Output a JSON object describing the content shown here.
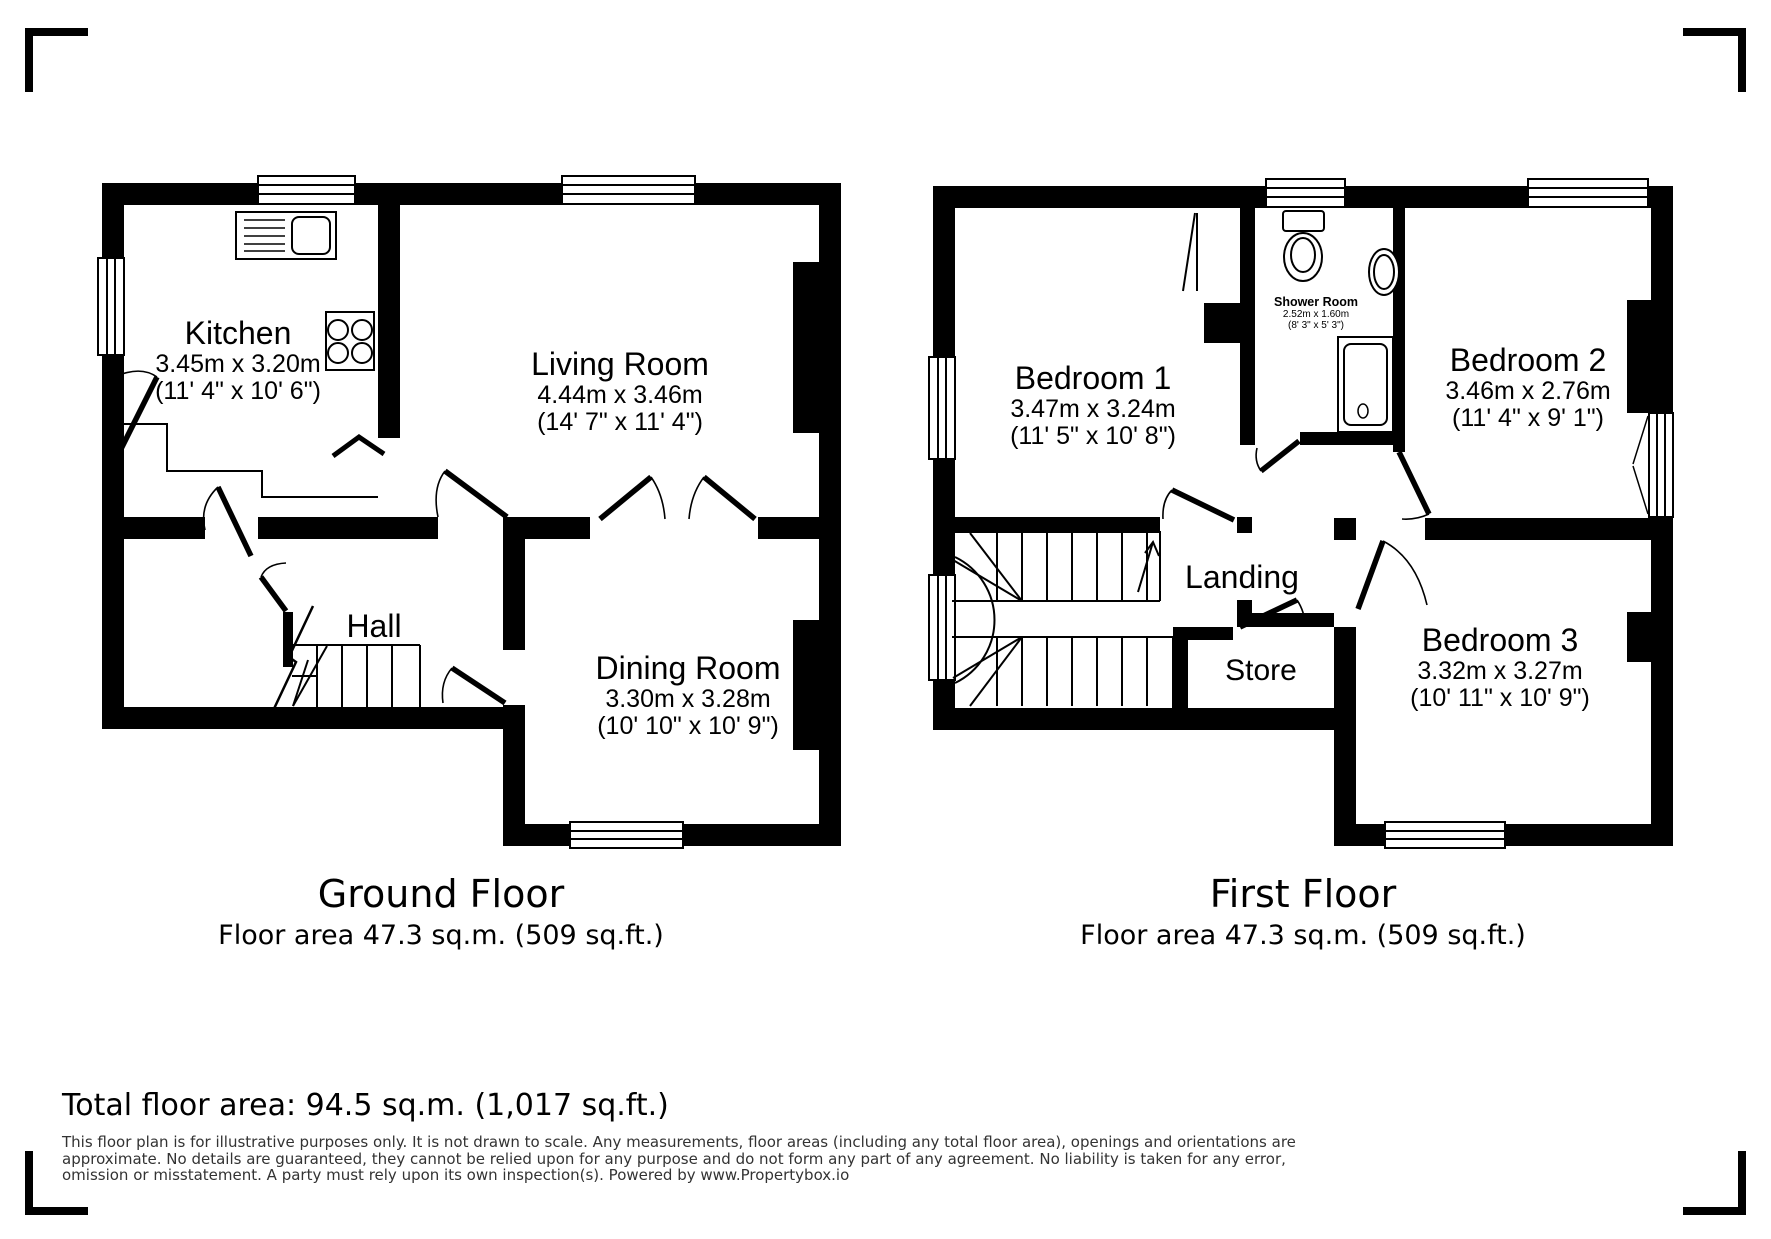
{
  "ground_floor": {
    "title": "Ground Floor",
    "area_label": "Floor area 47.3 sq.m. (509 sq.ft.)",
    "rooms": {
      "kitchen": {
        "name": "Kitchen",
        "metric": "3.45m x 3.20m",
        "imperial": "(11' 4\" x 10' 6\")"
      },
      "living_room": {
        "name": "Living Room",
        "metric": "4.44m x 3.46m",
        "imperial": "(14' 7\" x 11' 4\")"
      },
      "hall": {
        "name": "Hall"
      },
      "dining_room": {
        "name": "Dining Room",
        "metric": "3.30m x 3.28m",
        "imperial": "(10' 10\" x 10' 9\")"
      }
    }
  },
  "first_floor": {
    "title": "First Floor",
    "area_label": "Floor area 47.3 sq.m. (509 sq.ft.)",
    "rooms": {
      "bedroom1": {
        "name": "Bedroom 1",
        "metric": "3.47m x 3.24m",
        "imperial": "(11' 5\" x 10' 8\")"
      },
      "bedroom2": {
        "name": "Bedroom 2",
        "metric": "3.46m x 2.76m",
        "imperial": "(11' 4\" x 9' 1\")"
      },
      "bedroom3": {
        "name": "Bedroom 3",
        "metric": "3.32m x 3.27m",
        "imperial": "(10' 11\" x 10' 9\")"
      },
      "shower_room": {
        "name": "Shower Room",
        "metric": "2.52m x 1.60m",
        "imperial": "(8' 3\" x 5' 3\")"
      },
      "landing": {
        "name": "Landing"
      },
      "store": {
        "name": "Store"
      }
    }
  },
  "footer": {
    "total_area": "Total floor area: 94.5 sq.m. (1,017 sq.ft.)",
    "disclaimer_lines": [
      "This floor plan is for illustrative purposes only. It is not drawn to scale. Any measurements, floor areas (including any total floor area), openings and orientations are",
      "approximate. No details are guaranteed, they cannot be relied upon for any purpose and do not form any part of any agreement. No liability is taken for any error,",
      "omission or misstatement. A party must rely upon its own inspection(s). Powered by www.Propertybox.io"
    ]
  },
  "colors": {
    "wall": "#000000",
    "background": "#ffffff",
    "disclaimer_text": "#333333"
  }
}
